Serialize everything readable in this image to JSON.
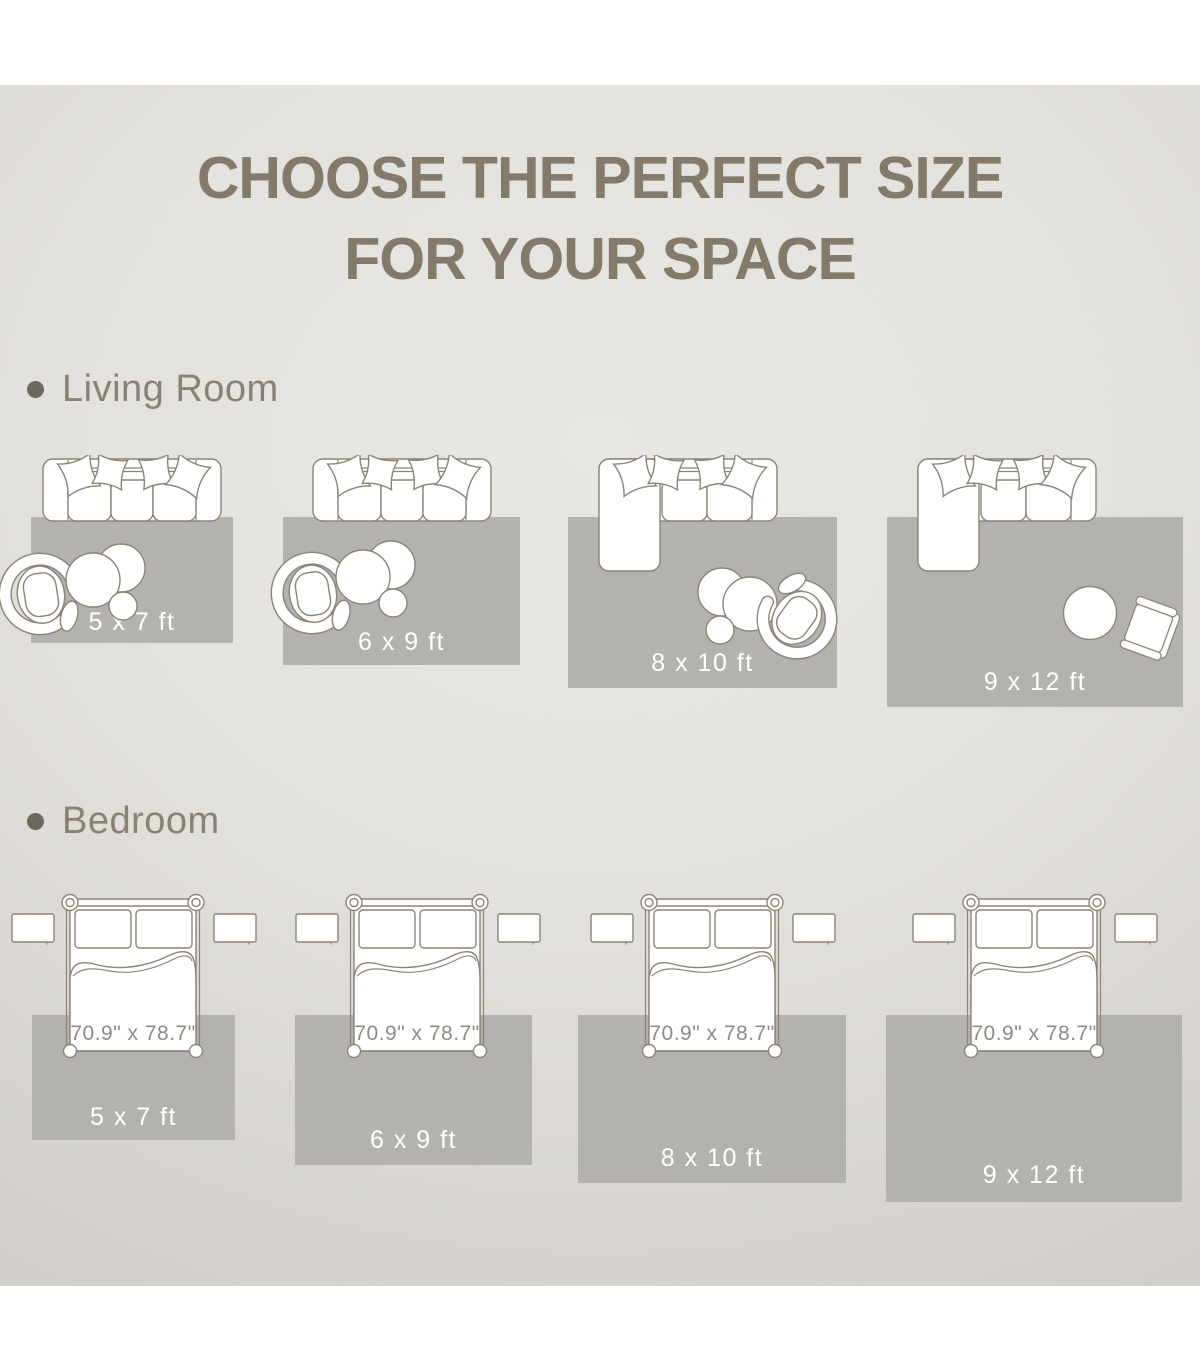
{
  "title": {
    "line1": "CHOOSE THE PERFECT SIZE",
    "line2": "FOR YOUR SPACE"
  },
  "sections": [
    {
      "label": "Living Room",
      "rugs": [
        {
          "size_label": "5 x 7 ft"
        },
        {
          "size_label": "6 x 9 ft"
        },
        {
          "size_label": "8 x 10 ft"
        },
        {
          "size_label": "9 x 12 ft"
        }
      ]
    },
    {
      "label": "Bedroom",
      "bed_size_label": "70.9\" x 78.7\"",
      "rugs": [
        {
          "size_label": "5 x 7 ft"
        },
        {
          "size_label": "6 x 9 ft"
        },
        {
          "size_label": "8 x 10 ft"
        },
        {
          "size_label": "9 x 12 ft"
        }
      ]
    }
  ],
  "icons": [
    "sofa-icon",
    "sectional-sofa-icon",
    "accent-chair-icon",
    "armchair-icon",
    "coffee-table-icon",
    "round-table-icon",
    "bed-icon",
    "nightstand-icon",
    "bullet-icon"
  ],
  "colors": {
    "title_text": "#837a6a",
    "section_text": "#8a8174",
    "bullet": "#6e675c",
    "rug_fill": "#b4b2ae",
    "rug_label_text": "#ffffff",
    "bed_label_text": "#8f8b84",
    "furniture_outline": "#8d8477",
    "furniture_fill": "#ffffff",
    "background_center": "#e9e7e3",
    "background_edge": "#d2cfca",
    "band": "#ffffff"
  }
}
